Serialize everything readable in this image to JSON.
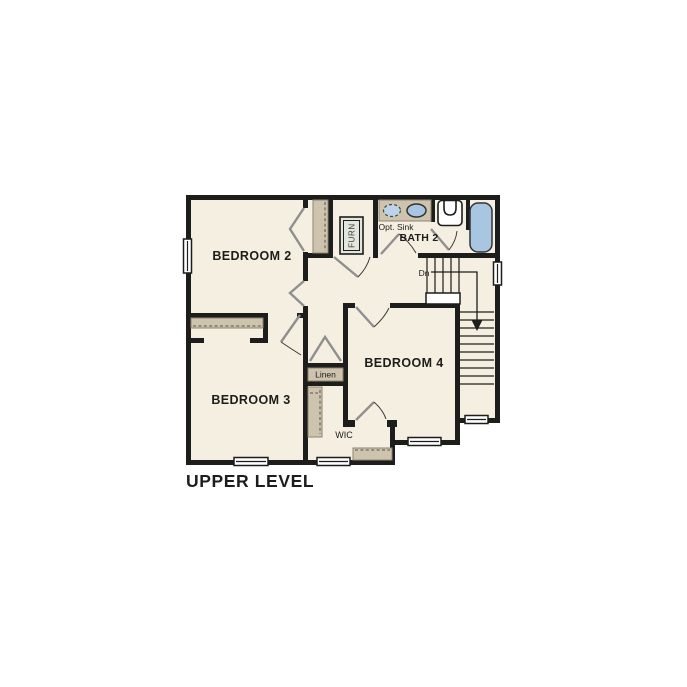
{
  "floor_title": "UPPER LEVEL",
  "rooms": {
    "bedroom2": {
      "label": "BEDROOM 2"
    },
    "bedroom3": {
      "label": "BEDROOM 3"
    },
    "bedroom4": {
      "label": "BEDROOM 4"
    },
    "bath2": {
      "label": "BATH 2"
    },
    "wic": {
      "label": "WIC"
    },
    "linen": {
      "label": "Linen"
    },
    "furnace": {
      "label": "FURN"
    }
  },
  "annotations": {
    "opt_sink": {
      "label": "Opt. Sink"
    },
    "stairs_down": {
      "label": "Dn"
    }
  },
  "colors": {
    "wall": "#1d1d1b",
    "floor": "#f5efe1",
    "casework": "#cec3ac",
    "casework_edge": "#8d8472",
    "fixture_blue": "#a8c6e2",
    "fixture_blue_light": "#bcd4ea",
    "door_leaf": "#8f8f8f",
    "background": "#ffffff",
    "text": "#1d1d1b"
  }
}
